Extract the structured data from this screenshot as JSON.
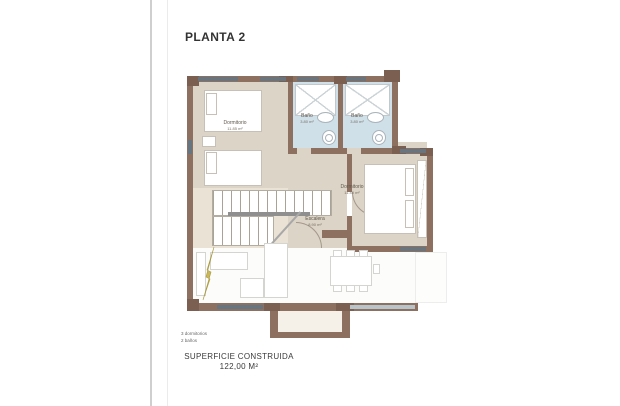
{
  "title": "PLANTA 2",
  "rooms": {
    "dormitorio1": {
      "name": "Dormitorio",
      "area": "11.85 m²"
    },
    "bano1": {
      "name": "Baño",
      "area": "3.80 m²"
    },
    "bano2": {
      "name": "Baño",
      "area": "3.80 m²"
    },
    "dormitorio2": {
      "name": "Dormitorio",
      "area": "11.40 m²"
    },
    "escalera": {
      "name": "Escalera",
      "area": "8.90 m²"
    }
  },
  "legend": {
    "bedrooms": "3 dormitorios",
    "bathrooms": "2 baños"
  },
  "footer": {
    "label": "SUPERFICIE CONSTRUIDA",
    "value": "122,00 M²"
  },
  "colors": {
    "wall": "#8e7061",
    "wall_dark": "#7b5f50",
    "floor_beige": "#dcd4c6",
    "floor_bath": "#cfe0e9",
    "window": "#66757f",
    "accent_arrow": "#b0a040"
  }
}
